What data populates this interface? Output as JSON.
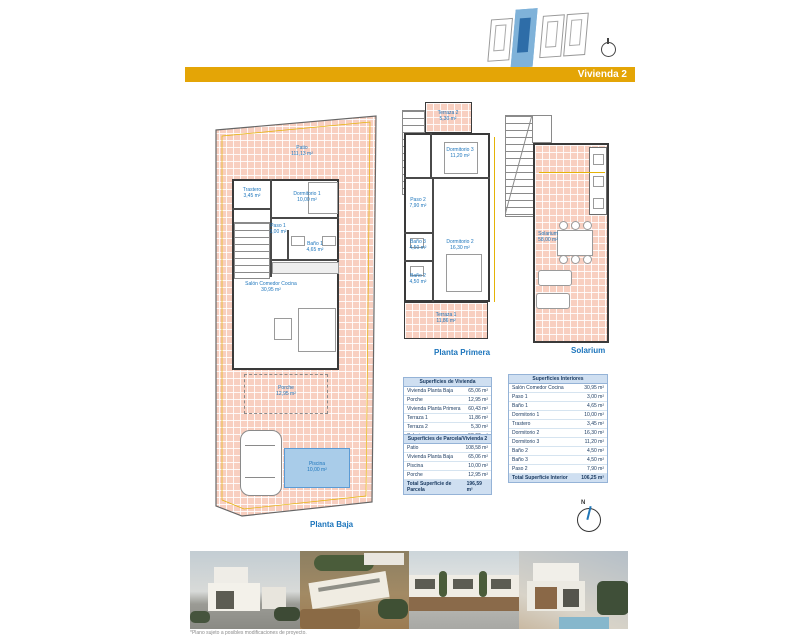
{
  "header": {
    "banner_label": "Vivienda 2"
  },
  "compass": {
    "north_label": "N"
  },
  "plans": {
    "planta_baja": {
      "label": "Planta Baja",
      "patio": {
        "name": "Patio",
        "area": "111,13 m²"
      },
      "trastero": {
        "name": "Trastero",
        "area": "3,45 m²"
      },
      "dormitorio1": {
        "name": "Dormitorio 1",
        "area": "10,00 m²"
      },
      "paso1": {
        "name": "Paso 1",
        "area": "3,00 m²"
      },
      "bano1": {
        "name": "Baño 1",
        "area": "4,65 m²"
      },
      "salon": {
        "name": "Salón Comedor Cocina",
        "area": "30,95 m²"
      },
      "porche": {
        "name": "Porche",
        "area": "12,95 m²"
      },
      "piscina": {
        "name": "Piscina",
        "area": "10,00 m²"
      }
    },
    "planta_primera": {
      "label": "Planta Primera",
      "terraza2": {
        "name": "Terraza 2",
        "area": "5,30 m²"
      },
      "dormitorio3": {
        "name": "Dormitorio 3",
        "area": "11,20 m²"
      },
      "paso2": {
        "name": "Paso 2",
        "area": "7,90 m²"
      },
      "bano3": {
        "name": "Baño 3",
        "area": "4,50 m²"
      },
      "bano2": {
        "name": "Baño 2",
        "area": "4,50 m²"
      },
      "dormitorio2": {
        "name": "Dormitorio 2",
        "area": "16,30 m²"
      },
      "terraza1": {
        "name": "Terraza 1",
        "area": "11,86 m²"
      }
    },
    "solarium": {
      "label": "Solarium",
      "solarium_room": {
        "name": "Solarium",
        "area": "58,00 m²"
      }
    }
  },
  "tables": {
    "vivienda": {
      "title": "Superficies de Vivienda",
      "rows": [
        {
          "label": "Vivienda Planta Baja",
          "value": "65,06 m²"
        },
        {
          "label": "Porche",
          "value": "12,95 m²"
        },
        {
          "label": "Vivienda Planta Primera",
          "value": "60,43 m²"
        },
        {
          "label": "Terraza 1",
          "value": "11,86 m²"
        },
        {
          "label": "Terraza 2",
          "value": "5,30 m²"
        },
        {
          "label": "Solarium",
          "value": "58,00 m²"
        }
      ],
      "total": {
        "label": "Total Superficie Vivienda",
        "value": "213,60 m²"
      }
    },
    "parcela": {
      "title": "Superficies de Parcela/Vivienda 2",
      "rows": [
        {
          "label": "Patio",
          "value": "108,58 m²"
        },
        {
          "label": "Vivienda Planta Baja",
          "value": "65,06 m²"
        },
        {
          "label": "Piscina",
          "value": "10,00 m²"
        },
        {
          "label": "Porche",
          "value": "12,95 m²"
        }
      ],
      "total": {
        "label": "Total Superficie de Parcela",
        "value": "196,59 m²"
      }
    },
    "interiores": {
      "title": "Superficies Interiores",
      "rows": [
        {
          "label": "Salón Comedor Cocina",
          "value": "30,95 m²"
        },
        {
          "label": "Paso 1",
          "value": "3,00 m²"
        },
        {
          "label": "Baño 1",
          "value": "4,65 m²"
        },
        {
          "label": "Dormitorio 1",
          "value": "10,00 m²"
        },
        {
          "label": "Trastero",
          "value": "3,45 m²"
        },
        {
          "label": "Dormitorio 2",
          "value": "16,30 m²"
        },
        {
          "label": "Dormitorio 3",
          "value": "11,20 m²"
        },
        {
          "label": "Baño 2",
          "value": "4,50 m²"
        },
        {
          "label": "Baño 3",
          "value": "4,50 m²"
        },
        {
          "label": "Paso 2",
          "value": "7,90 m²"
        }
      ],
      "total": {
        "label": "Total Superficie Interior",
        "value": "106,25 m²"
      }
    }
  },
  "footer": {
    "caption": "*Plano sujeto a posibles modificaciones de proyecto."
  },
  "colors": {
    "accent_gold": "#E4A506",
    "label_blue": "#1C75BC",
    "tile_salmon": "#F8CFC0",
    "highlight_blue": "#7FB2D9",
    "pool_blue": "#A9CCE9",
    "dim_yellow": "#E5B307"
  }
}
